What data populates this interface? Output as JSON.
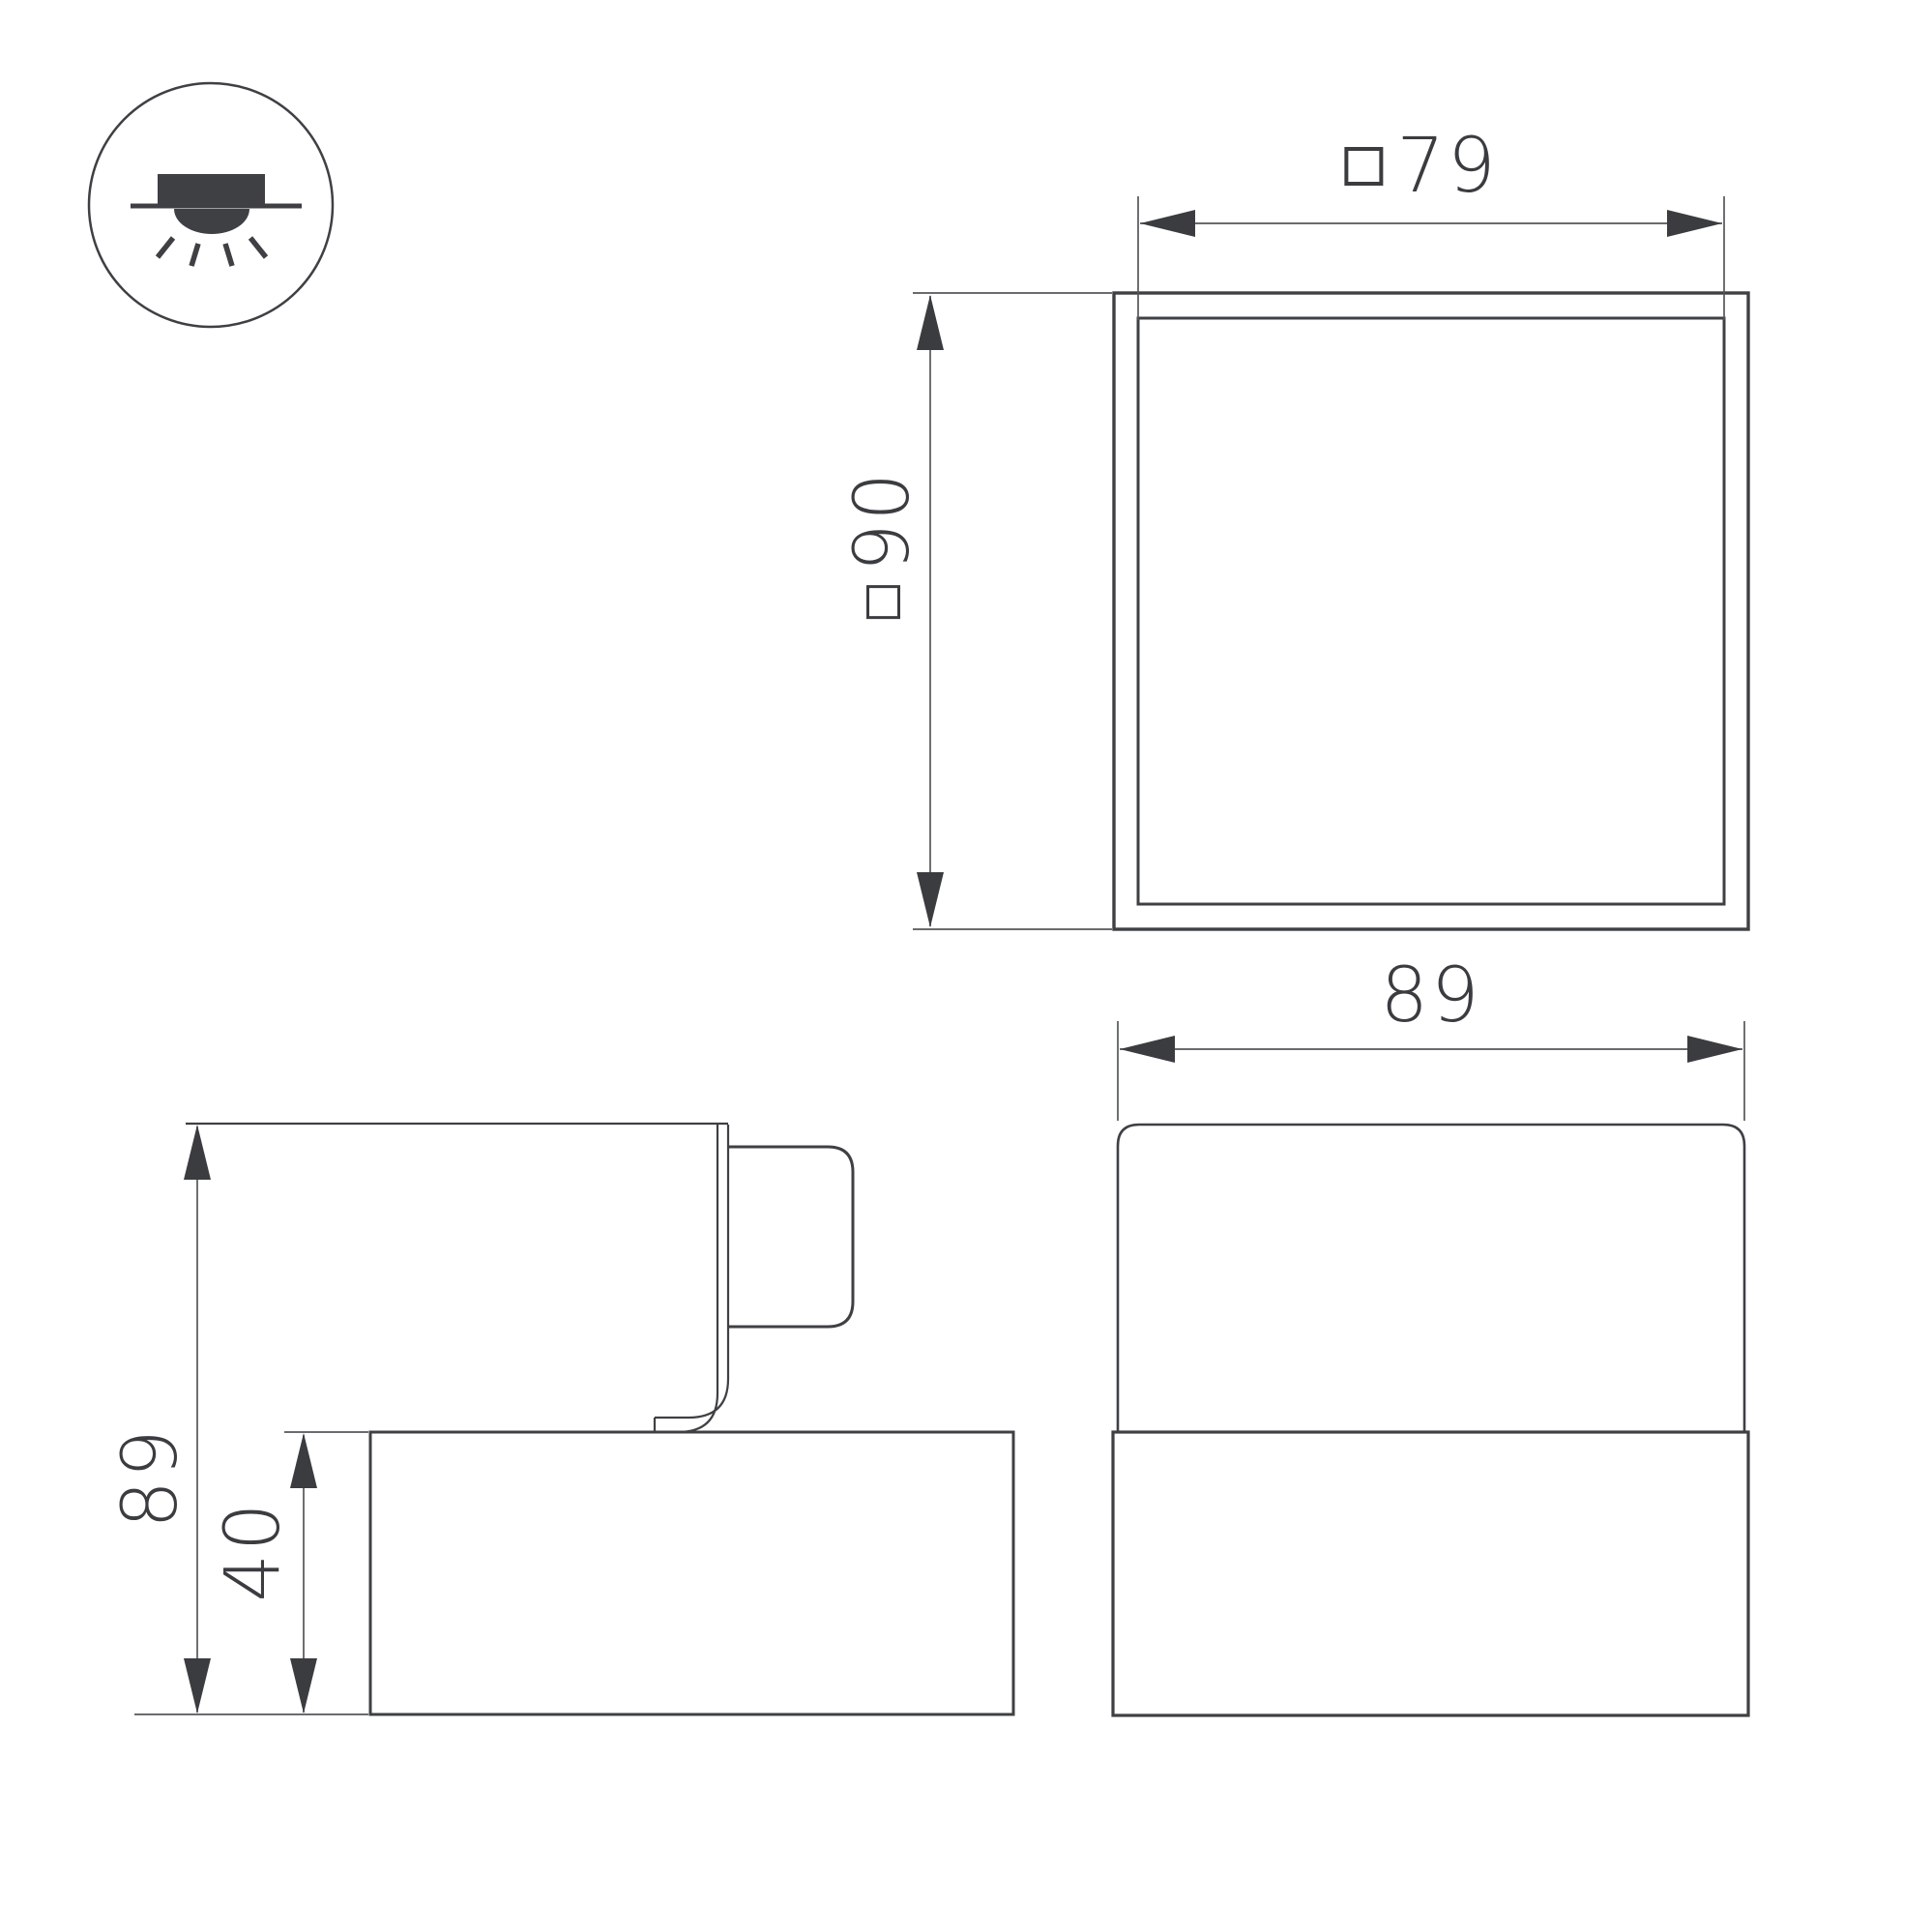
{
  "drawing": {
    "background_color": "#ffffff",
    "line_color": "#3e4044",
    "text_color": "#3a3c40",
    "mount_icon": {
      "meaning": "surface-mounted-downlight",
      "elements": [
        "ceiling-line",
        "fixture-body",
        "light-dome",
        "light-rays"
      ]
    },
    "dims": {
      "top_inner": {
        "square_symbol": "□",
        "value": "79"
      },
      "top_outer": {
        "square_symbol": "□",
        "value": "90"
      },
      "front_width": {
        "value": "89"
      },
      "side_height": {
        "value": "89"
      },
      "side_base_height": {
        "value": "40"
      }
    },
    "views": [
      {
        "name": "top-view",
        "outer_size_mm": 90,
        "inner_size_mm": 79
      },
      {
        "name": "side-view",
        "height_mm": 89,
        "base_height_mm": 40
      },
      {
        "name": "front-view",
        "width_mm": 89
      }
    ]
  }
}
